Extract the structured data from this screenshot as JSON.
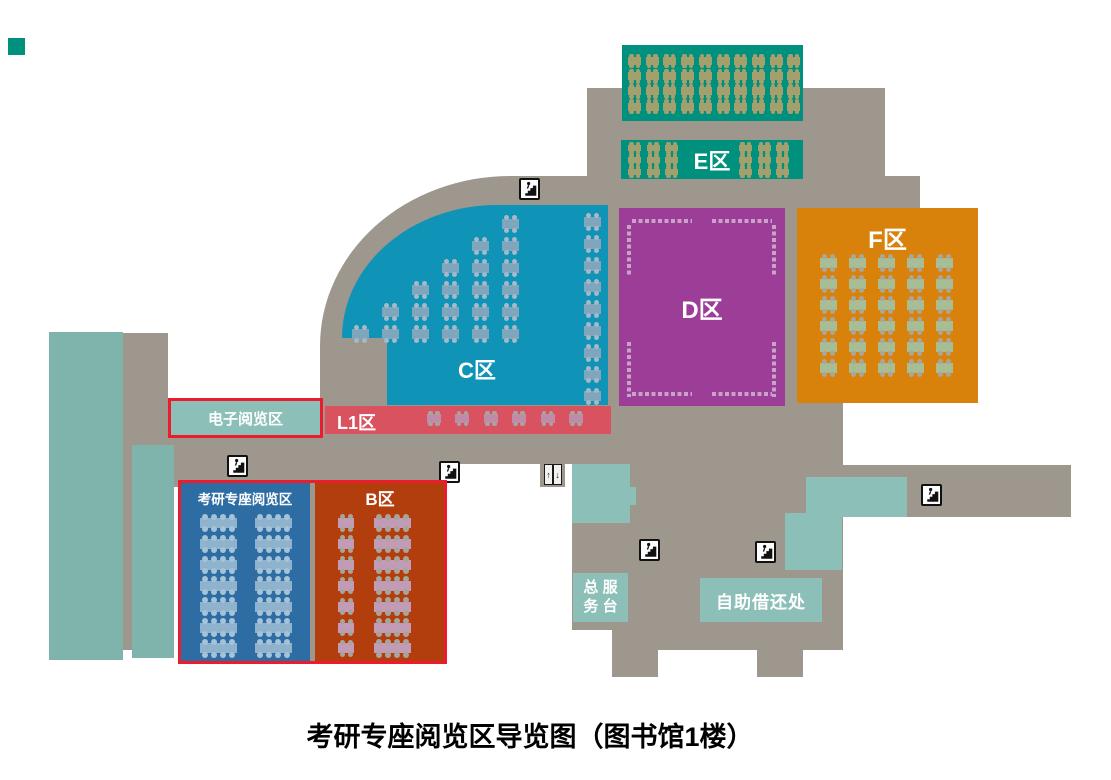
{
  "title": "考研专座阅览区导览图（图书馆1楼）",
  "colors": {
    "floor_gray": "#9E978E",
    "wall_teal": "#7EB4AC",
    "service_teal": "#8CBFB7",
    "highlight_red_border": "#EC1C2C",
    "white": "#FFFFFF"
  },
  "zones": {
    "e_hall": {
      "label": "E区",
      "color": "#00907E",
      "text_color": "#FFFFFF"
    },
    "c": {
      "label": "C区",
      "color": "#0F93B7",
      "text_color": "#FFFFFF"
    },
    "d": {
      "label": "D区",
      "color": "#9C3E98",
      "text_color": "#FFFFFF",
      "shelf_dash_color": "#C9A2C8"
    },
    "f": {
      "label": "F区",
      "color": "#D8820B",
      "text_color": "#FFFFFF"
    },
    "l1": {
      "label": "L1区",
      "color": "#D8525F",
      "text_color": "#FFFFFF"
    },
    "kaoyan": {
      "label": "考研专座阅览区",
      "color": "#2E6DA4",
      "text_color": "#FFFFFF"
    },
    "b": {
      "label": "B区",
      "color": "#B23E0D",
      "text_color": "#FFFFFF"
    },
    "electronic": {
      "label": "电子阅览区",
      "color": "#8CBFB7",
      "border_color": "#EC1C2C",
      "text_color": "#FFFFFF"
    }
  },
  "facilities": {
    "service_desk": {
      "line1": "总 服",
      "line2": "务 台",
      "color": "#8CBFB7",
      "text_color": "#FFFFFF"
    },
    "self_checkout": {
      "label": "自助借还处",
      "color": "#8CBFB7",
      "text_color": "#FFFFFF"
    },
    "elevator": {
      "up": "↑",
      "down": "↓"
    }
  },
  "map_icons": {
    "stairs": [
      [
        519,
        178
      ],
      [
        227,
        455
      ],
      [
        439,
        461
      ],
      [
        639,
        539
      ],
      [
        755,
        541
      ],
      [
        921,
        484
      ]
    ],
    "elevator": [
      544,
      464
    ]
  },
  "furniture_groups": [
    {
      "name": "e-upper-tables",
      "x": 628,
      "y": 56,
      "cols": 10,
      "rows": 4,
      "dx": 17.7,
      "dy": 15.2,
      "w": 13,
      "h": 10,
      "seats": 2,
      "table_color": "#A3A06E",
      "seat_color": "#A3A06E"
    },
    {
      "name": "e-lower-left-tables",
      "x": 628,
      "y": 144,
      "cols": 3,
      "rows": 3,
      "dx": 18.5,
      "dy": 11.8,
      "w": 13,
      "h": 8,
      "seats": 2,
      "table_color": "#A3A06E",
      "seat_color": "#A3A06E"
    },
    {
      "name": "e-lower-right-tables",
      "x": 739,
      "y": 144,
      "cols": 3,
      "rows": 3,
      "dx": 18.5,
      "dy": 11.8,
      "w": 13,
      "h": 8,
      "seats": 2,
      "table_color": "#A3A06E",
      "seat_color": "#A3A06E"
    },
    {
      "name": "f-tables",
      "x": 820,
      "y": 257,
      "cols": 5,
      "rows": 6,
      "dx": 29,
      "dy": 21,
      "w": 17,
      "h": 12,
      "seats": 2,
      "table_color": "#A7BD96",
      "seat_color": "#A9A69B"
    },
    {
      "name": "c-right-tables",
      "x": 584,
      "y": 216,
      "cols": 1,
      "rows": 9,
      "dx": 0,
      "dy": 21.8,
      "w": 17,
      "h": 12,
      "seats": 2,
      "table_color": "#80A6BE",
      "seat_color": "#A6B9C6"
    },
    {
      "name": "c-stair-tables",
      "staircase": true,
      "x": 502,
      "y": 218,
      "rows": 6,
      "dx": 30,
      "dy": 22,
      "w": 17,
      "h": 12,
      "seats": 2,
      "table_color": "#80A6BE",
      "seat_color": "#A6B9C6"
    },
    {
      "name": "l1-tables",
      "x": 427,
      "y": 413,
      "cols": 6,
      "rows": 1,
      "dx": 28.4,
      "dy": 0,
      "w": 14,
      "h": 11,
      "seats": 2,
      "table_color": "#BE8CA9",
      "seat_color": "#A9A49B"
    },
    {
      "name": "kaoyan-tables-left",
      "x": 200,
      "y": 517,
      "cols": 1,
      "rows": 7,
      "dx": 0,
      "dy": 20.9,
      "w": 37,
      "h": 12,
      "seats": 4,
      "table_color": "#8FB3CD",
      "seat_color": "#A4C2D8"
    },
    {
      "name": "kaoyan-tables-right",
      "x": 255,
      "y": 517,
      "cols": 1,
      "rows": 7,
      "dx": 0,
      "dy": 20.9,
      "w": 37,
      "h": 12,
      "seats": 4,
      "table_color": "#8FB3CD",
      "seat_color": "#A4C2D8"
    },
    {
      "name": "b-short-tables",
      "x": 338,
      "y": 517,
      "cols": 1,
      "rows": 7,
      "dx": 0,
      "dy": 20.9,
      "w": 16,
      "h": 12,
      "seats": 2,
      "table_color": "#C29CB7",
      "seat_color": "#A9A49B"
    },
    {
      "name": "b-long-tables",
      "x": 374,
      "y": 517,
      "cols": 1,
      "rows": 7,
      "dx": 0,
      "dy": 20.9,
      "w": 37,
      "h": 12,
      "seats": 4,
      "table_color": "#C29CB7",
      "seat_color": "#A9A49B"
    }
  ]
}
